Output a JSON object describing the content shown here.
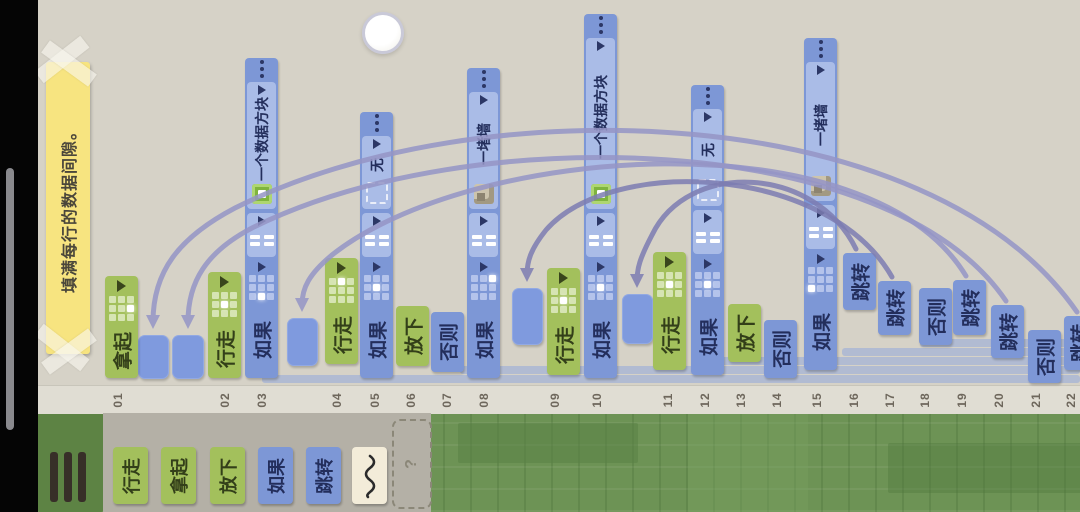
{
  "note": {
    "text": "填满每行的数据间隙。"
  },
  "ruler": {
    "marks": [
      {
        "n": "01",
        "x": 118
      },
      {
        "n": "02",
        "x": 225
      },
      {
        "n": "03",
        "x": 262
      },
      {
        "n": "04",
        "x": 337
      },
      {
        "n": "05",
        "x": 375
      },
      {
        "n": "06",
        "x": 411
      },
      {
        "n": "07",
        "x": 447
      },
      {
        "n": "08",
        "x": 484
      },
      {
        "n": "09",
        "x": 555
      },
      {
        "n": "10",
        "x": 597
      },
      {
        "n": "11",
        "x": 668
      },
      {
        "n": "12",
        "x": 705
      },
      {
        "n": "13",
        "x": 741
      },
      {
        "n": "14",
        "x": 777
      },
      {
        "n": "15",
        "x": 817
      },
      {
        "n": "16",
        "x": 854
      },
      {
        "n": "17",
        "x": 890
      },
      {
        "n": "18",
        "x": 925
      },
      {
        "n": "19",
        "x": 962
      },
      {
        "n": "20",
        "x": 999
      },
      {
        "n": "21",
        "x": 1036
      },
      {
        "n": "22",
        "x": 1071
      }
    ]
  },
  "palette": {
    "items": [
      {
        "name": "walk",
        "label": "行走",
        "color": "green",
        "x": 113
      },
      {
        "name": "pickup",
        "label": "拿起",
        "color": "green",
        "x": 161
      },
      {
        "name": "drop",
        "label": "放下",
        "color": "green",
        "x": 210
      },
      {
        "name": "if",
        "label": "如果",
        "color": "blue",
        "x": 258
      },
      {
        "name": "jump",
        "label": "跳转",
        "color": "blue",
        "x": 306
      },
      {
        "name": "any",
        "label": "",
        "color": "cream",
        "x": 352,
        "icon": "squiggle"
      }
    ],
    "help_label": "?"
  },
  "program": {
    "columns": [
      {
        "num": "01",
        "kind": "pickup",
        "label": "拿起",
        "color": "green",
        "x": 105,
        "y": 276,
        "h": 102,
        "white": 5
      },
      {
        "num": "02",
        "kind": "walk",
        "label": "行走",
        "color": "green",
        "x": 208,
        "y": 272,
        "h": 106,
        "white": 4
      },
      {
        "num": "03",
        "kind": "if",
        "label": "如果",
        "color": "blue",
        "x": 245,
        "y": 58,
        "h": 320,
        "operand": "一个数据方块",
        "icon": "databox",
        "white": 7
      },
      {
        "num": "04",
        "kind": "walk",
        "label": "行走",
        "color": "green",
        "x": 325,
        "y": 258,
        "h": 106,
        "white": 1
      },
      {
        "num": "05",
        "kind": "if",
        "label": "如果",
        "color": "blue",
        "x": 360,
        "y": 112,
        "h": 266,
        "operand": "无",
        "icon": "none",
        "white": 4
      },
      {
        "num": "06",
        "kind": "drop",
        "label": "放下",
        "color": "green",
        "x": 396,
        "y": 306,
        "h": 60
      },
      {
        "num": "07",
        "kind": "else",
        "label": "否则",
        "color": "blue",
        "x": 431,
        "y": 312,
        "h": 60
      },
      {
        "num": "08",
        "kind": "if",
        "label": "如果",
        "color": "blue",
        "x": 467,
        "y": 68,
        "h": 310,
        "operand": "一堵墙",
        "icon": "wall",
        "white": 2
      },
      {
        "num": "09",
        "kind": "walk",
        "label": "行走",
        "color": "green",
        "x": 547,
        "y": 268,
        "h": 107,
        "white": 4
      },
      {
        "num": "10",
        "kind": "if",
        "label": "如果",
        "color": "blue",
        "x": 584,
        "y": 14,
        "h": 364,
        "operand": "一个数据方块",
        "icon": "databox",
        "white": 4
      },
      {
        "num": "11",
        "kind": "walk",
        "label": "行走",
        "color": "green",
        "x": 653,
        "y": 252,
        "h": 118,
        "white": 4
      },
      {
        "num": "12",
        "kind": "if",
        "label": "如果",
        "color": "blue",
        "x": 691,
        "y": 85,
        "h": 290,
        "operand": "无",
        "icon": "none",
        "white": 4
      },
      {
        "num": "13",
        "kind": "drop",
        "label": "放下",
        "color": "green",
        "x": 728,
        "y": 304,
        "h": 58
      },
      {
        "num": "14",
        "kind": "else",
        "label": "否则",
        "color": "blue",
        "x": 764,
        "y": 320,
        "h": 58
      },
      {
        "num": "15",
        "kind": "if",
        "label": "如果",
        "color": "blue",
        "x": 804,
        "y": 38,
        "h": 332,
        "operand": "一堵墙",
        "icon": "wall",
        "white": 6
      },
      {
        "num": "16",
        "kind": "jump",
        "label": "跳转",
        "color": "blue",
        "x": 843,
        "y": 253,
        "h": 57
      },
      {
        "num": "17",
        "kind": "jump",
        "label": "跳转",
        "color": "blue",
        "x": 878,
        "y": 281,
        "h": 54
      },
      {
        "num": "18",
        "kind": "else",
        "label": "否则",
        "color": "blue",
        "x": 919,
        "y": 288,
        "h": 57
      },
      {
        "num": "19",
        "kind": "jump",
        "label": "跳转",
        "color": "blue",
        "x": 953,
        "y": 280,
        "h": 55
      },
      {
        "num": "20",
        "kind": "jump",
        "label": "跳转",
        "color": "blue",
        "x": 991,
        "y": 305,
        "h": 53
      },
      {
        "num": "21",
        "kind": "else",
        "label": "否则",
        "color": "blue",
        "x": 1028,
        "y": 330,
        "h": 53
      },
      {
        "num": "22",
        "kind": "jump",
        "label": "跳转",
        "color": "blue",
        "x": 1064,
        "y": 316,
        "h": 54,
        "w": 30
      }
    ],
    "pads": [
      {
        "x": 138,
        "y": 335,
        "w": 31,
        "h": 44
      },
      {
        "x": 172,
        "y": 335,
        "w": 32,
        "h": 44
      },
      {
        "x": 287,
        "y": 318,
        "w": 31,
        "h": 48
      },
      {
        "x": 512,
        "y": 288,
        "w": 31,
        "h": 57
      },
      {
        "x": 622,
        "y": 294,
        "w": 31,
        "h": 50
      }
    ],
    "arcs": [
      {
        "d": "M 1077 312 C 930 100 480 85 235 208 C 178 238 153 272 153 322",
        "dark": false
      },
      {
        "d": "M 1006 301 C 890 130 470 120 252 228 C 206 252 188 282 188 322",
        "dark": false
      },
      {
        "d": "M 966 276 C 868 115 470 145 332 255 C 309 274 302 288 302 305",
        "dark": false
      },
      {
        "d": "M 892 277 C 828 165 612 155 546 230 C 530 250 527 262 527 275",
        "dark": true
      },
      {
        "d": "M 856 249 C 815 165 688 160 652 235 C 640 258 637 268 637 281",
        "dark": true
      }
    ],
    "scope_bars": [
      {
        "x": 262,
        "y": 375,
        "w": 818
      },
      {
        "x": 460,
        "y": 366,
        "w": 620
      },
      {
        "x": 705,
        "y": 357,
        "w": 375
      },
      {
        "x": 842,
        "y": 348,
        "w": 238
      },
      {
        "x": 920,
        "y": 339,
        "w": 160
      }
    ]
  },
  "colors": {
    "background": "#d6d2c7",
    "green_block": "#a3c05c",
    "blue_block": "#7d97d6",
    "blue_light": "#aabce7",
    "pad": "#7f9ade",
    "connector": "#9595c6",
    "note": "#f7e480",
    "board_green": "#6d9355",
    "tray": "#b4b0a6",
    "cream": "#f3ecd9"
  }
}
